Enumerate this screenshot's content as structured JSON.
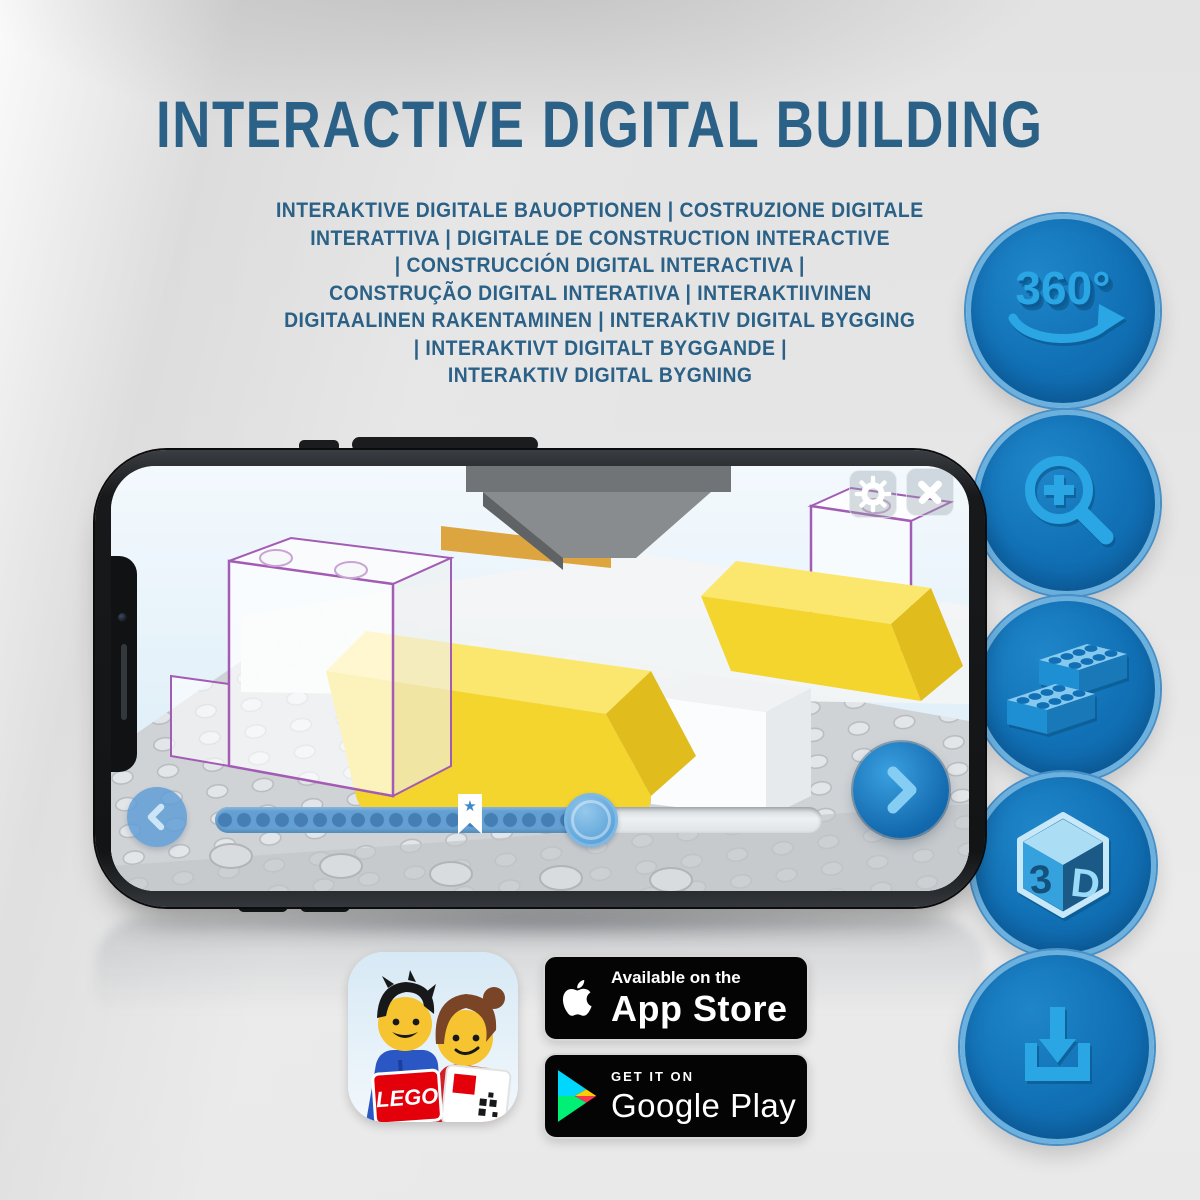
{
  "header": {
    "title": "INTERACTIVE DIGITAL BUILDING",
    "subtitle_lines": [
      "INTERAKTIVE DIGITALE BAUOPTIONEN | COSTRUZIONE DIGITALE",
      "INTERATTIVA | DIGITALE DE CONSTRUCTION INTERACTIVE",
      "| CONSTRUCCIÓN DIGITAL INTERACTIVA |",
      "CONSTRUÇÃO DIGITAL INTERATIVA | INTERAKTIIVINEN",
      "DIGITAALINEN RAKENTAMINEN | INTERAKTIV DIGITAL BYGGING",
      "| INTERAKTIVT DIGITALT BYGGANDE |",
      "INTERAKTIV DIGITAL BYGNING"
    ]
  },
  "features": {
    "rotate_360": {
      "label": "360°",
      "icon": "360-rotation-icon"
    },
    "zoom": {
      "icon": "zoom-in-magnifier-icon"
    },
    "bricks": {
      "icon": "lego-bricks-icon"
    },
    "three_d": {
      "icon": "3d-cube-icon",
      "left_face_label": "3",
      "right_face_label": "D"
    },
    "download": {
      "icon": "download-tray-icon"
    }
  },
  "phone": {
    "screen": {
      "settings_icon": "gear-icon",
      "close_icon": "close-icon",
      "rotate_icon": "rotate-clockwise-icon",
      "back_icon": "chevron-left-icon",
      "next_icon": "chevron-right-icon",
      "marker_icon": "star-bookmark-icon",
      "marker_glyph": "★",
      "progress_percent": 62,
      "marker_percent": 42
    }
  },
  "badges": {
    "app_store": {
      "tagline": "Available on the",
      "store_name": "App Store",
      "icon": "apple-icon"
    },
    "google_play": {
      "tagline": "GET IT ON",
      "store_name": "Google Play",
      "icon": "google-play-triangle-icon"
    },
    "lego_app": {
      "logo_text": "LEGO",
      "icon": "lego-builder-app-icon"
    }
  },
  "colors": {
    "heading_blue": "#2b6187",
    "circle_fill": "#1170b5",
    "circle_border": "#6cb0de",
    "icon_blue": "#2ba6e4",
    "icon_shadow_blue": "#0c5b95",
    "slider_fill": "#639fd2",
    "brick_yellow": "#f4d52e",
    "outline_purple": "#a35cb4",
    "badge_black": "#040404"
  }
}
